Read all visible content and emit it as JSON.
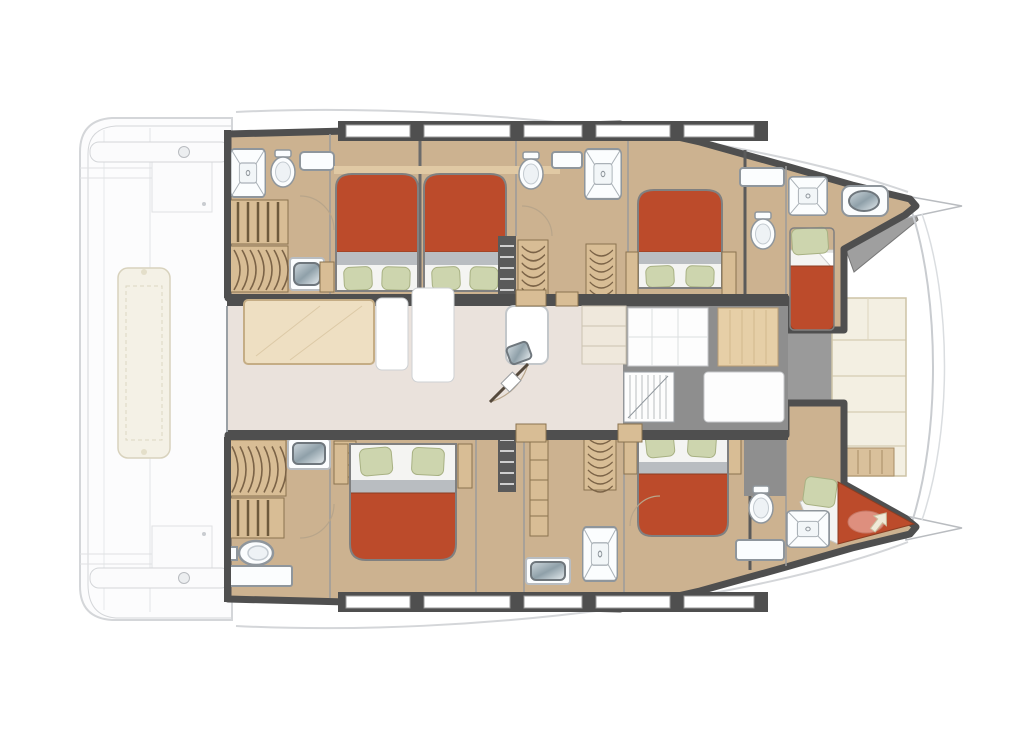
{
  "meta": {
    "diagram_type": "yacht-floorplan",
    "vessel_type": "catamaran",
    "view": "top-down interior deck plan",
    "hull_count": 2,
    "bow_direction": "right"
  },
  "areas": [
    "aft-deck",
    "top-hull-cabins",
    "bottom-hull-cabins",
    "salon-galley",
    "forward-cockpit",
    "foredeck-lounge",
    "bow-tips"
  ],
  "inventory": {
    "double_berths": 5,
    "single_berths": 2,
    "showers": 5,
    "toilets": 6,
    "wardrobes": 5,
    "staircases": 4,
    "tables": 2,
    "aft_bench_cushions": 1,
    "foredeck_cushion_panels": 4
  },
  "palette": {
    "paper": "#ffffff",
    "deck_fill": "#fcfcfd",
    "deck_line": "#d4d6d9",
    "hull_wall": "#4f4f4f",
    "cabin_floor": "#ccb290",
    "wood": "#d8bd95",
    "wood_line": "#8a734f",
    "salon_floor": "#eae2dc",
    "table_wood": "#eedfc2",
    "bed_red": "#bc4b2b",
    "bed_red_edge": "#8c3d22",
    "mattress_gray": "#b9bdc1",
    "pillow_green": "#cdd5ae",
    "pillow_edge": "#a8b183",
    "sheet_white": "#f4f4f2",
    "fixture_white": "#fbfdfe",
    "fixture_line": "#8f969c",
    "metal_dark": "#8fa0a9",
    "metal_light": "#e8eef1",
    "cockpit_gray": "#8e8e8e",
    "walkway_gray": "#9a9a9a",
    "cushion_cream": "#f3efe2",
    "cushion_line": "#cdc3a6",
    "toilet_overlay_pink": "#e59c8d"
  }
}
